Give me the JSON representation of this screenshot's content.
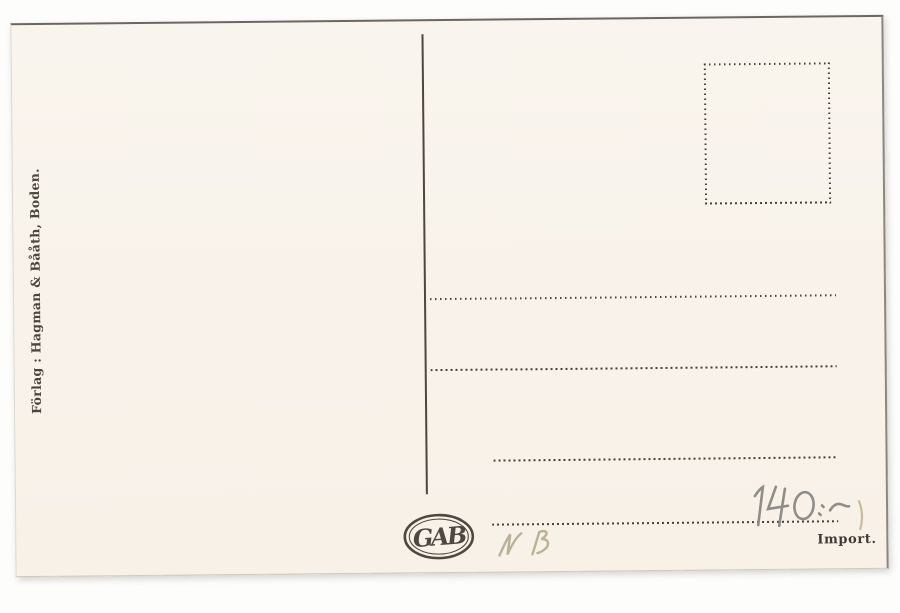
{
  "postcard_back": {
    "publisher_line": "Förlag : Hagman & Bååth, Boden.",
    "monogram": "GAB",
    "import_label": "Import.",
    "handwritten": {
      "price": "140:-",
      "initials": "NB"
    },
    "colors": {
      "background": "#fdfdfc",
      "paper": "#f8f2ea",
      "ink": "#46413a",
      "pencil": "#8e8d88",
      "pencil_faint": "#bab293"
    }
  }
}
